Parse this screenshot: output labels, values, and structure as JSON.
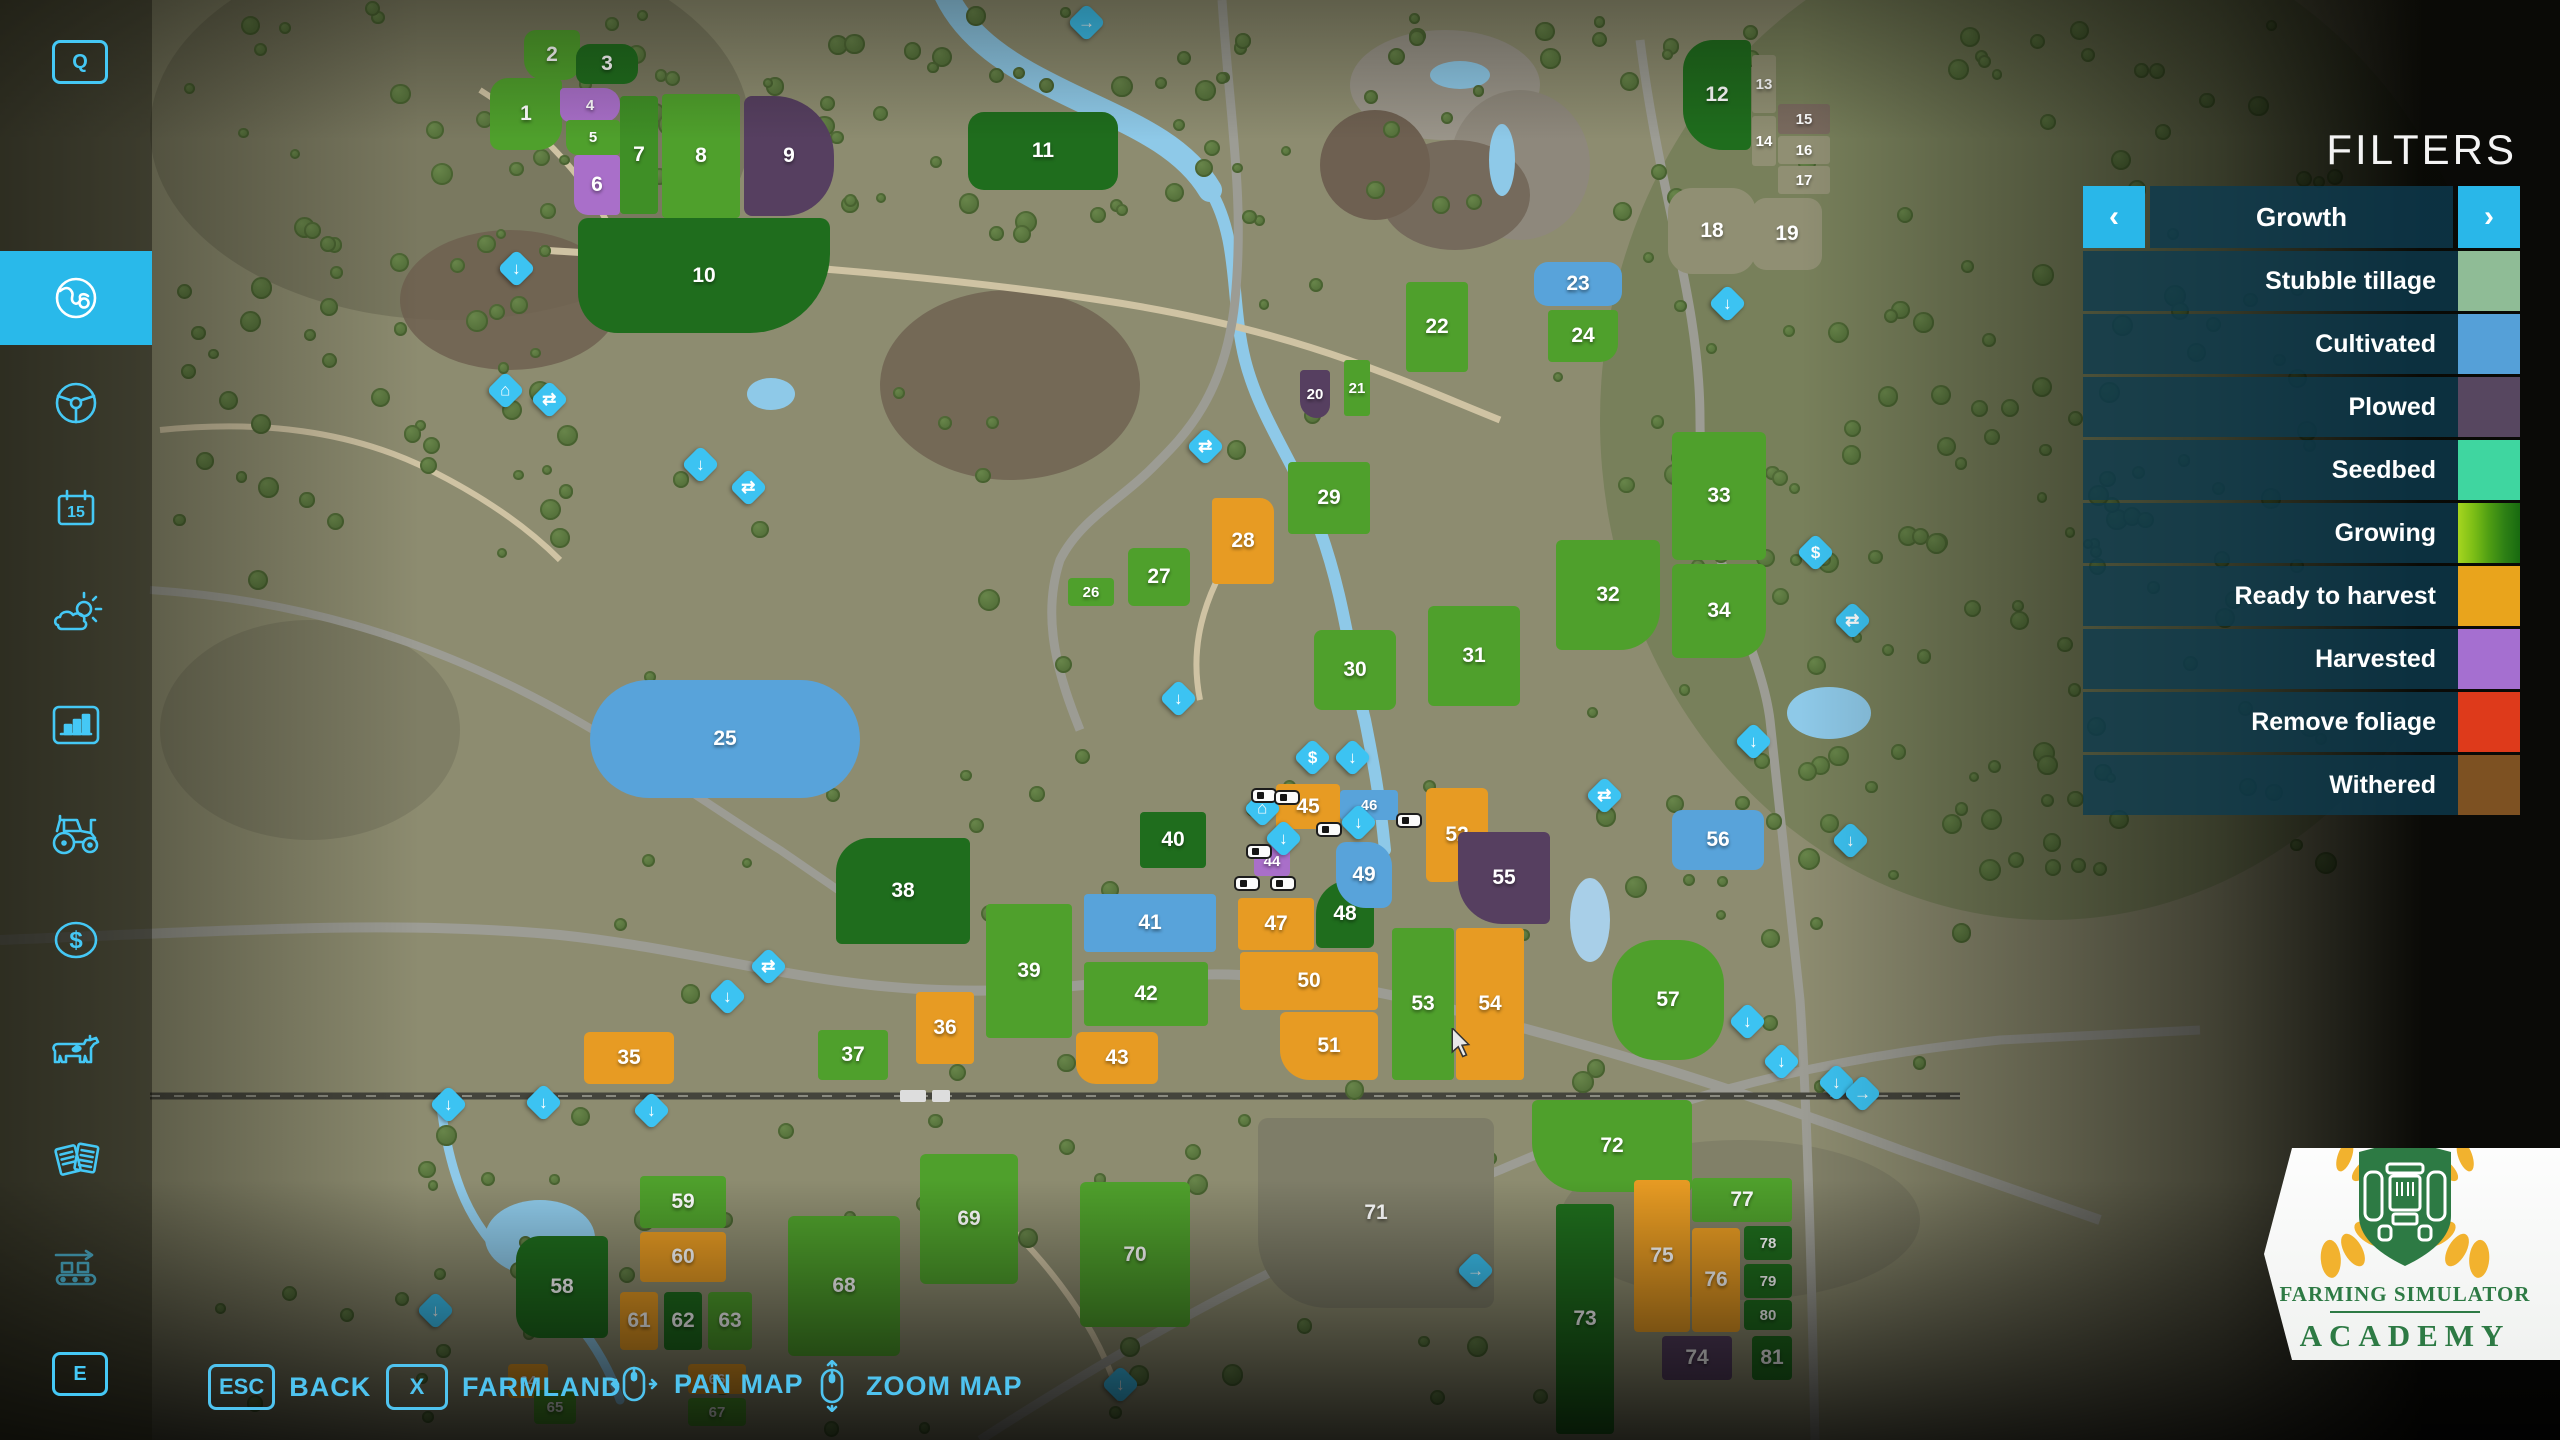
{
  "sidebar": {
    "hotkey_top": "Q",
    "hotkey_bottom": "E",
    "items": [
      {
        "name": "map",
        "icon": "globe-icon",
        "active": true
      },
      {
        "name": "vehicles-overview",
        "icon": "steering-wheel-icon",
        "active": false
      },
      {
        "name": "calendar",
        "icon": "calendar-icon",
        "active": false,
        "day": "15"
      },
      {
        "name": "weather",
        "icon": "weather-icon",
        "active": false
      },
      {
        "name": "statistics",
        "icon": "bar-chart-icon",
        "active": false
      },
      {
        "name": "garage",
        "icon": "tractor-icon",
        "active": false
      },
      {
        "name": "finances",
        "icon": "dollar-icon",
        "active": false
      },
      {
        "name": "animals",
        "icon": "cow-icon",
        "active": false
      },
      {
        "name": "contracts",
        "icon": "documents-icon",
        "active": false
      },
      {
        "name": "production",
        "icon": "conveyor-icon",
        "active": false
      }
    ]
  },
  "filters": {
    "title": "FILTERS",
    "header": {
      "label": "Growth",
      "prev": "‹",
      "next": "›"
    },
    "items": [
      {
        "label": "Stubble tillage",
        "color": "#8fbc96"
      },
      {
        "label": "Cultivated",
        "color": "#55a0d8"
      },
      {
        "label": "Plowed",
        "color": "#574760"
      },
      {
        "label": "Seedbed",
        "color": "#3fd6a0"
      },
      {
        "label": "Growing",
        "colors": [
          "#a6d51f",
          "#7cbe16",
          "#4f9e13",
          "#2e8015",
          "#186a10"
        ]
      },
      {
        "label": "Ready to harvest",
        "color": "#e9a41c"
      },
      {
        "label": "Harvested",
        "color": "#a56fd0"
      },
      {
        "label": "Remove foliage",
        "color": "#de3a1b"
      },
      {
        "label": "Withered",
        "color": "#7d5122"
      }
    ]
  },
  "bottom_bar": {
    "back": {
      "key": "ESC",
      "label": "BACK"
    },
    "farmland": {
      "key": "X",
      "label": "FARMLAND"
    },
    "pan": {
      "label": "PAN MAP"
    },
    "zoom": {
      "label": "ZOOM MAP"
    }
  },
  "logo": {
    "line1": "FARMING SIMULATOR",
    "line2": "ACADEMY"
  },
  "map": {
    "palette": {
      "green": "#4fa02c",
      "green2": "#3f8f26",
      "dgreen": "#1f6d1d",
      "blue": "#58a3da",
      "orange": "#e79b23",
      "lilac": "#a96fc9",
      "plow": "#563f60",
      "bare": "#908f73",
      "bare71": "#7e7d68",
      "brown": "#7a6b5f"
    },
    "fields": [
      {
        "n": "1",
        "x": 490,
        "y": 78,
        "w": 72,
        "h": 72,
        "c": "green",
        "r": "18px 6px 24px 10px"
      },
      {
        "n": "2",
        "x": 524,
        "y": 30,
        "w": 56,
        "h": 50,
        "c": "green",
        "r": "12px 6px 16px 20px"
      },
      {
        "n": "3",
        "x": 576,
        "y": 44,
        "w": 62,
        "h": 40,
        "c": "dgreen",
        "r": "14px 16px 14px 10px"
      },
      {
        "n": "4",
        "x": 560,
        "y": 88,
        "w": 60,
        "h": 34,
        "c": "lilac",
        "r": "4px 16px 16px 10px"
      },
      {
        "n": "5",
        "x": 566,
        "y": 120,
        "w": 54,
        "h": 35,
        "c": "green",
        "r": "4px 4px 4px 12px"
      },
      {
        "n": "6",
        "x": 574,
        "y": 155,
        "w": 46,
        "h": 60,
        "c": "lilac",
        "r": "4px 4px 4px 14px"
      },
      {
        "n": "7",
        "x": 620,
        "y": 96,
        "w": 38,
        "h": 118,
        "c": "green2",
        "r": "4px"
      },
      {
        "n": "8",
        "x": 662,
        "y": 94,
        "w": 78,
        "h": 124,
        "c": "green",
        "r": "4px"
      },
      {
        "n": "9",
        "x": 744,
        "y": 96,
        "w": 90,
        "h": 120,
        "c": "plow",
        "r": "8px 60px 50px 8px"
      },
      {
        "n": "10",
        "x": 578,
        "y": 218,
        "w": 252,
        "h": 115,
        "c": "dgreen",
        "r": "10px 10px 80px 40px"
      },
      {
        "n": "11",
        "x": 968,
        "y": 112,
        "w": 150,
        "h": 78,
        "c": "dgreen",
        "r": "16px"
      },
      {
        "n": "12",
        "x": 1683,
        "y": 40,
        "w": 68,
        "h": 110,
        "c": "dgreen",
        "r": "30px 6px 6px 40px"
      },
      {
        "n": "13",
        "x": 1752,
        "y": 55,
        "w": 24,
        "h": 58,
        "c": "bare",
        "r": "3px"
      },
      {
        "n": "14",
        "x": 1752,
        "y": 116,
        "w": 24,
        "h": 50,
        "c": "bare",
        "r": "3px"
      },
      {
        "n": "15",
        "x": 1778,
        "y": 104,
        "w": 52,
        "h": 30,
        "c": "brown",
        "r": "3px"
      },
      {
        "n": "16",
        "x": 1778,
        "y": 136,
        "w": 52,
        "h": 28,
        "c": "bare",
        "r": "3px"
      },
      {
        "n": "17",
        "x": 1778,
        "y": 166,
        "w": 52,
        "h": 28,
        "c": "bare",
        "r": "3px"
      },
      {
        "n": "18",
        "x": 1668,
        "y": 188,
        "w": 88,
        "h": 86,
        "c": "bare",
        "r": "24px"
      },
      {
        "n": "19",
        "x": 1752,
        "y": 198,
        "w": 70,
        "h": 72,
        "c": "bare",
        "r": "14px"
      },
      {
        "n": "20",
        "x": 1300,
        "y": 370,
        "w": 30,
        "h": 48,
        "c": "plow",
        "r": "4px 4px 14px 18px"
      },
      {
        "n": "21",
        "x": 1344,
        "y": 360,
        "w": 26,
        "h": 56,
        "c": "green",
        "r": "3px"
      },
      {
        "n": "22",
        "x": 1406,
        "y": 282,
        "w": 62,
        "h": 90,
        "c": "green",
        "r": "4px"
      },
      {
        "n": "23",
        "x": 1534,
        "y": 262,
        "w": 88,
        "h": 44,
        "c": "blue",
        "r": "14px"
      },
      {
        "n": "24",
        "x": 1548,
        "y": 310,
        "w": 70,
        "h": 52,
        "c": "green",
        "r": "4px 4px 18px 4px"
      },
      {
        "n": "25",
        "x": 590,
        "y": 680,
        "w": 270,
        "h": 118,
        "c": "blue",
        "r": "60px"
      },
      {
        "n": "26",
        "x": 1068,
        "y": 578,
        "w": 46,
        "h": 28,
        "c": "green",
        "r": "4px"
      },
      {
        "n": "27",
        "x": 1128,
        "y": 548,
        "w": 62,
        "h": 58,
        "c": "green",
        "r": "6px"
      },
      {
        "n": "28",
        "x": 1212,
        "y": 498,
        "w": 62,
        "h": 86,
        "c": "orange",
        "r": "4px 14px 4px 4px"
      },
      {
        "n": "29",
        "x": 1288,
        "y": 462,
        "w": 82,
        "h": 72,
        "c": "green",
        "r": "4px"
      },
      {
        "n": "30",
        "x": 1314,
        "y": 630,
        "w": 82,
        "h": 80,
        "c": "green",
        "r": "8px"
      },
      {
        "n": "31",
        "x": 1428,
        "y": 606,
        "w": 92,
        "h": 100,
        "c": "green",
        "r": "6px"
      },
      {
        "n": "32",
        "x": 1556,
        "y": 540,
        "w": 104,
        "h": 110,
        "c": "green",
        "r": "6px 6px 40px 6px"
      },
      {
        "n": "33",
        "x": 1672,
        "y": 432,
        "w": 94,
        "h": 128,
        "c": "green",
        "r": "6px"
      },
      {
        "n": "34",
        "x": 1672,
        "y": 564,
        "w": 94,
        "h": 94,
        "c": "green",
        "r": "6px 6px 30px 6px"
      },
      {
        "n": "35",
        "x": 584,
        "y": 1032,
        "w": 90,
        "h": 52,
        "c": "orange",
        "r": "6px"
      },
      {
        "n": "36",
        "x": 916,
        "y": 992,
        "w": 58,
        "h": 72,
        "c": "orange",
        "r": "4px"
      },
      {
        "n": "37",
        "x": 818,
        "y": 1030,
        "w": 70,
        "h": 50,
        "c": "green",
        "r": "4px"
      },
      {
        "n": "38",
        "x": 836,
        "y": 838,
        "w": 134,
        "h": 106,
        "c": "dgreen",
        "r": "34px 6px 6px 6px"
      },
      {
        "n": "39",
        "x": 986,
        "y": 904,
        "w": 86,
        "h": 134,
        "c": "green",
        "r": "4px"
      },
      {
        "n": "40",
        "x": 1140,
        "y": 812,
        "w": 66,
        "h": 56,
        "c": "dgreen",
        "r": "4px"
      },
      {
        "n": "41",
        "x": 1084,
        "y": 894,
        "w": 132,
        "h": 58,
        "c": "blue",
        "r": "4px"
      },
      {
        "n": "42",
        "x": 1084,
        "y": 962,
        "w": 124,
        "h": 64,
        "c": "green",
        "r": "4px"
      },
      {
        "n": "43",
        "x": 1076,
        "y": 1032,
        "w": 82,
        "h": 52,
        "c": "orange",
        "r": "6px 6px 6px 20px"
      },
      {
        "n": "44",
        "x": 1254,
        "y": 846,
        "w": 36,
        "h": 30,
        "c": "lilac",
        "r": "4px"
      },
      {
        "n": "45",
        "x": 1276,
        "y": 784,
        "w": 64,
        "h": 45,
        "c": "orange",
        "r": "4px"
      },
      {
        "n": "46",
        "x": 1340,
        "y": 790,
        "w": 58,
        "h": 30,
        "c": "blue",
        "r": "4px"
      },
      {
        "n": "47",
        "x": 1238,
        "y": 898,
        "w": 76,
        "h": 52,
        "c": "orange",
        "r": "4px"
      },
      {
        "n": "48",
        "x": 1316,
        "y": 880,
        "w": 58,
        "h": 68,
        "c": "dgreen",
        "r": "34px 6px 6px 6px"
      },
      {
        "n": "49",
        "x": 1336,
        "y": 842,
        "w": 56,
        "h": 66,
        "c": "blue",
        "r": "10px 24px 10px 30px"
      },
      {
        "n": "50",
        "x": 1240,
        "y": 952,
        "w": 138,
        "h": 58,
        "c": "orange",
        "r": "4px"
      },
      {
        "n": "51",
        "x": 1280,
        "y": 1012,
        "w": 98,
        "h": 68,
        "c": "orange",
        "r": "6px 6px 6px 30px"
      },
      {
        "n": "52",
        "x": 1426,
        "y": 788,
        "w": 62,
        "h": 94,
        "c": "orange",
        "r": "6px 6px 40px 6px"
      },
      {
        "n": "53",
        "x": 1392,
        "y": 928,
        "w": 62,
        "h": 152,
        "c": "green",
        "r": "4px"
      },
      {
        "n": "54",
        "x": 1456,
        "y": 928,
        "w": 68,
        "h": 152,
        "c": "orange",
        "r": "4px"
      },
      {
        "n": "55",
        "x": 1458,
        "y": 832,
        "w": 92,
        "h": 92,
        "c": "plow",
        "r": "6px 6px 6px 44px"
      },
      {
        "n": "56",
        "x": 1672,
        "y": 810,
        "w": 92,
        "h": 60,
        "c": "blue",
        "r": "10px"
      },
      {
        "n": "57",
        "x": 1612,
        "y": 940,
        "w": 112,
        "h": 120,
        "c": "green",
        "r": "44px"
      },
      {
        "n": "58",
        "x": 516,
        "y": 1236,
        "w": 92,
        "h": 102,
        "c": "dgreen",
        "r": "24px 6px 6px 24px"
      },
      {
        "n": "59",
        "x": 640,
        "y": 1176,
        "w": 86,
        "h": 52,
        "c": "green",
        "r": "4px"
      },
      {
        "n": "60",
        "x": 640,
        "y": 1232,
        "w": 86,
        "h": 50,
        "c": "orange",
        "r": "4px"
      },
      {
        "n": "61",
        "x": 620,
        "y": 1292,
        "w": 38,
        "h": 58,
        "c": "orange",
        "r": "4px"
      },
      {
        "n": "62",
        "x": 664,
        "y": 1292,
        "w": 38,
        "h": 58,
        "c": "dgreen",
        "r": "4px"
      },
      {
        "n": "63",
        "x": 708,
        "y": 1292,
        "w": 44,
        "h": 58,
        "c": "green",
        "r": "4px"
      },
      {
        "n": "64",
        "x": 508,
        "y": 1364,
        "w": 40,
        "h": 34,
        "c": "orange",
        "r": "4px"
      },
      {
        "n": "65",
        "x": 534,
        "y": 1390,
        "w": 42,
        "h": 34,
        "c": "green",
        "r": "4px"
      },
      {
        "n": "66",
        "x": 688,
        "y": 1364,
        "w": 58,
        "h": 30,
        "c": "orange",
        "r": "4px"
      },
      {
        "n": "67",
        "x": 688,
        "y": 1398,
        "w": 58,
        "h": 28,
        "c": "green",
        "r": "4px"
      },
      {
        "n": "68",
        "x": 788,
        "y": 1216,
        "w": 112,
        "h": 140,
        "c": "green",
        "r": "6px"
      },
      {
        "n": "69",
        "x": 920,
        "y": 1154,
        "w": 98,
        "h": 130,
        "c": "green",
        "r": "6px"
      },
      {
        "n": "70",
        "x": 1080,
        "y": 1182,
        "w": 110,
        "h": 145,
        "c": "green",
        "r": "6px"
      },
      {
        "n": "71",
        "x": 1258,
        "y": 1118,
        "w": 236,
        "h": 190,
        "c": "bare71",
        "r": "10px 10px 10px 70px"
      },
      {
        "n": "72",
        "x": 1532,
        "y": 1100,
        "w": 160,
        "h": 92,
        "c": "green",
        "r": "6px 6px 6px 50px"
      },
      {
        "n": "73",
        "x": 1556,
        "y": 1204,
        "w": 58,
        "h": 230,
        "c": "dgreen",
        "r": "4px"
      },
      {
        "n": "74",
        "x": 1662,
        "y": 1336,
        "w": 70,
        "h": 44,
        "c": "plow",
        "r": "4px"
      },
      {
        "n": "75",
        "x": 1634,
        "y": 1180,
        "w": 56,
        "h": 152,
        "c": "orange",
        "r": "4px"
      },
      {
        "n": "76",
        "x": 1692,
        "y": 1228,
        "w": 48,
        "h": 104,
        "c": "orange",
        "r": "4px"
      },
      {
        "n": "77",
        "x": 1692,
        "y": 1178,
        "w": 100,
        "h": 44,
        "c": "green",
        "r": "4px"
      },
      {
        "n": "78",
        "x": 1744,
        "y": 1226,
        "w": 48,
        "h": 34,
        "c": "dgreen",
        "r": "4px"
      },
      {
        "n": "79",
        "x": 1744,
        "y": 1264,
        "w": 48,
        "h": 34,
        "c": "dgreen",
        "r": "4px"
      },
      {
        "n": "80",
        "x": 1744,
        "y": 1300,
        "w": 48,
        "h": 30,
        "c": "dgreen",
        "r": "4px"
      },
      {
        "n": "81",
        "x": 1752,
        "y": 1336,
        "w": 40,
        "h": 44,
        "c": "dgreen",
        "r": "4px"
      }
    ],
    "icons": [
      {
        "x": 516,
        "y": 268,
        "t": "down"
      },
      {
        "x": 505,
        "y": 390,
        "t": "home"
      },
      {
        "x": 549,
        "y": 399,
        "t": "people"
      },
      {
        "x": 700,
        "y": 464,
        "t": "down"
      },
      {
        "x": 748,
        "y": 487,
        "t": "people"
      },
      {
        "x": 1205,
        "y": 446,
        "t": "people"
      },
      {
        "x": 1086,
        "y": 22,
        "t": "conveyor"
      },
      {
        "x": 1727,
        "y": 303,
        "t": "down"
      },
      {
        "x": 1178,
        "y": 698,
        "t": "down"
      },
      {
        "x": 1312,
        "y": 757,
        "t": "fuel"
      },
      {
        "x": 1352,
        "y": 757,
        "t": "down"
      },
      {
        "x": 1262,
        "y": 808,
        "t": "home"
      },
      {
        "x": 1283,
        "y": 838,
        "t": "down"
      },
      {
        "x": 1358,
        "y": 822,
        "t": "down"
      },
      {
        "x": 1604,
        "y": 795,
        "t": "people"
      },
      {
        "x": 1753,
        "y": 741,
        "t": "down"
      },
      {
        "x": 1815,
        "y": 552,
        "t": "fuel"
      },
      {
        "x": 1852,
        "y": 620,
        "t": "people"
      },
      {
        "x": 768,
        "y": 966,
        "t": "people"
      },
      {
        "x": 727,
        "y": 996,
        "t": "down"
      },
      {
        "x": 448,
        "y": 1104,
        "t": "down"
      },
      {
        "x": 543,
        "y": 1102,
        "t": "down"
      },
      {
        "x": 651,
        "y": 1110,
        "t": "down"
      },
      {
        "x": 435,
        "y": 1310,
        "t": "down"
      },
      {
        "x": 1475,
        "y": 1270,
        "t": "conveyor"
      },
      {
        "x": 1120,
        "y": 1384,
        "t": "down"
      },
      {
        "x": 1747,
        "y": 1021,
        "t": "down"
      },
      {
        "x": 1781,
        "y": 1061,
        "t": "down"
      },
      {
        "x": 1836,
        "y": 1082,
        "t": "down"
      },
      {
        "x": 1862,
        "y": 1093,
        "t": "conveyor"
      },
      {
        "x": 1850,
        "y": 840,
        "t": "down"
      }
    ],
    "vehicles": [
      {
        "x": 1253,
        "y": 790
      },
      {
        "x": 1276,
        "y": 792
      },
      {
        "x": 1318,
        "y": 824
      },
      {
        "x": 1398,
        "y": 815
      },
      {
        "x": 1248,
        "y": 846
      },
      {
        "x": 1236,
        "y": 878
      },
      {
        "x": 1272,
        "y": 878
      }
    ]
  }
}
